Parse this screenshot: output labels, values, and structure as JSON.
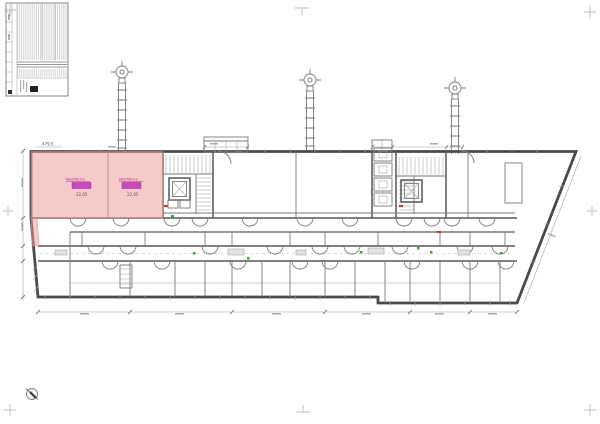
{
  "sheet": {
    "background": "#ffffff",
    "kind_label": "floor-plan-sheet"
  },
  "colors": {
    "wall": "#4a4a4a",
    "thin_line": "#787878",
    "faint_line": "#a6a6a6",
    "crop_mark": "#bdbdbd",
    "highlight_fill": "#ef9a9a",
    "highlight_edge": "#d88888",
    "tag_magenta": "#c84bbd",
    "annotation_magenta": "#b3269f",
    "marker_green": "#3f9f3f",
    "marker_red": "#cc3333",
    "logo_black": "#222222"
  },
  "dims": {
    "top_left": "479,5"
  },
  "highlight": {
    "rooms": [
      {
        "name": "Mietfläche",
        "area": "22,05"
      },
      {
        "name": "Mietfläche",
        "area": "22,05"
      }
    ]
  }
}
